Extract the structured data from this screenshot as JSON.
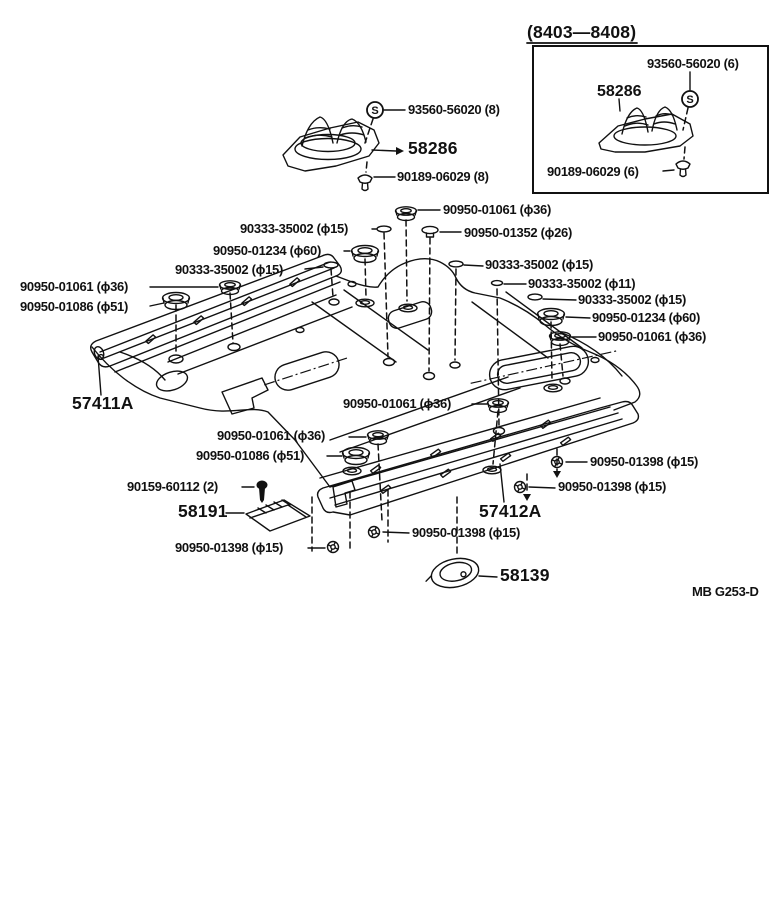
{
  "symbols": {
    "s": "S"
  },
  "inset": {
    "period": "(8403—8408)",
    "screw_label": "93560-56020 (6)",
    "boot_label": "58286",
    "clip_label": "90189-06029 (6)"
  },
  "labels": {
    "boot_screw": "93560-56020 (8)",
    "boot": "58286",
    "boot_clip": "90189-06029 (8)",
    "plug36_top": "90950-01061 (ϕ36)",
    "plug26": "90950-01352 (ϕ26)",
    "washer15_a": "90333-35002 (ϕ15)",
    "grommet60_l": "90950-01234 (ϕ60)",
    "washer15_b": "90333-35002 (ϕ15)",
    "grommet36_l": "90950-01061 (ϕ36)",
    "grommet51_l": "90950-01086 (ϕ51)",
    "washer15_c": "90333-35002 (ϕ15)",
    "washer11": "90333-35002 (ϕ11)",
    "washer15_d": "90333-35002 (ϕ15)",
    "grommet60_r": "90950-01234 (ϕ60)",
    "grommet36_r": "90950-01061 (ϕ36)",
    "sill_lh": "57411A",
    "grommet36_mid_r": "90950-01061 (ϕ36)",
    "grommet36_mid_l": "90950-01061 (ϕ36)",
    "grommet51_mid": "90950-01086 (ϕ51)",
    "screw_58191": "90159-60112 (2)",
    "plate": "58191",
    "plug1398_r1": "90950-01398 (ϕ15)",
    "plug1398_r2": "90950-01398 (ϕ15)",
    "sill_rh": "57412A",
    "plug1398_b_mid": "90950-01398 (ϕ15)",
    "plug1398_b_left": "90950-01398 (ϕ15)",
    "cover": "58139"
  },
  "footer": {
    "code": "MB  G253-D"
  }
}
